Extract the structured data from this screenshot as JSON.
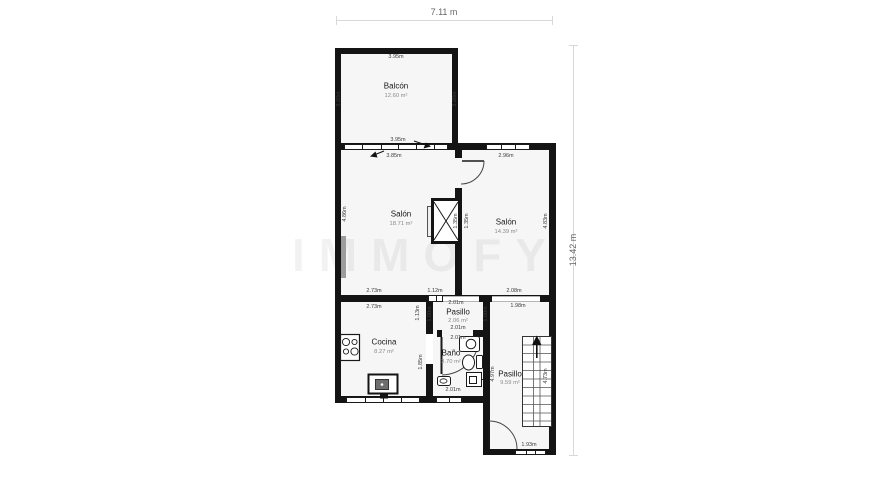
{
  "watermark": "IMMOFY",
  "overall": {
    "width_label": "7.11 m",
    "height_label": "13.42 m"
  },
  "colors": {
    "wall": "#141414",
    "room_fill": "#f6f6f6",
    "dim_line": "#d8d8d8",
    "dim_text": "#3c3c3c",
    "window_gray": "#9c9c9c"
  },
  "rooms": {
    "balcon": {
      "name": "Balcón",
      "area": "12.60 m²"
    },
    "salon_left": {
      "name": "Salón",
      "area": "18.71 m²"
    },
    "salon_right": {
      "name": "Salón",
      "area": "14.39 m²"
    },
    "cocina": {
      "name": "Cocina",
      "area": "8.27 m²"
    },
    "pasillo_mid": {
      "name": "Pasillo",
      "area": "2.06 m²"
    },
    "bano": {
      "name": "Baño",
      "area": "3.70 m²"
    },
    "pasillo_right": {
      "name": "Pasillo",
      "area": "9.59 m²"
    }
  },
  "dims": {
    "balcon_top": "3.95m",
    "balcon_bottom": "3.95m",
    "balcon_left": "3.20m",
    "balcon_right": "3.20m",
    "salon_left_top": "3.85m",
    "salon_left_side": "4.86m",
    "salon_left_bottom": "2.73m",
    "salon_right_top": "2.96m",
    "salon_right_side": "4.83m",
    "salon_right_bottom": "2.08m",
    "window_mid": "1.12m",
    "cocina_top": "2.73m",
    "cocina_side": "1.13m",
    "pasillo_mid_top": "2.01m",
    "pasillo_mid_bottom": "2.01m",
    "pasillo_mid_left": "1.00m",
    "pasillo_mid_right": "1.00m",
    "pasillo_right_top": "1.98m",
    "pasillo_right_height": "4.97m",
    "pasillo_right_wall": "4.73m",
    "pasillo_right_bottom": "1.93m",
    "bano_top": "2.01m",
    "bano_left": "1.85m",
    "bano_bottom": "2.01m",
    "shaft_left": "1.35m",
    "shaft_right": "1.35m"
  }
}
